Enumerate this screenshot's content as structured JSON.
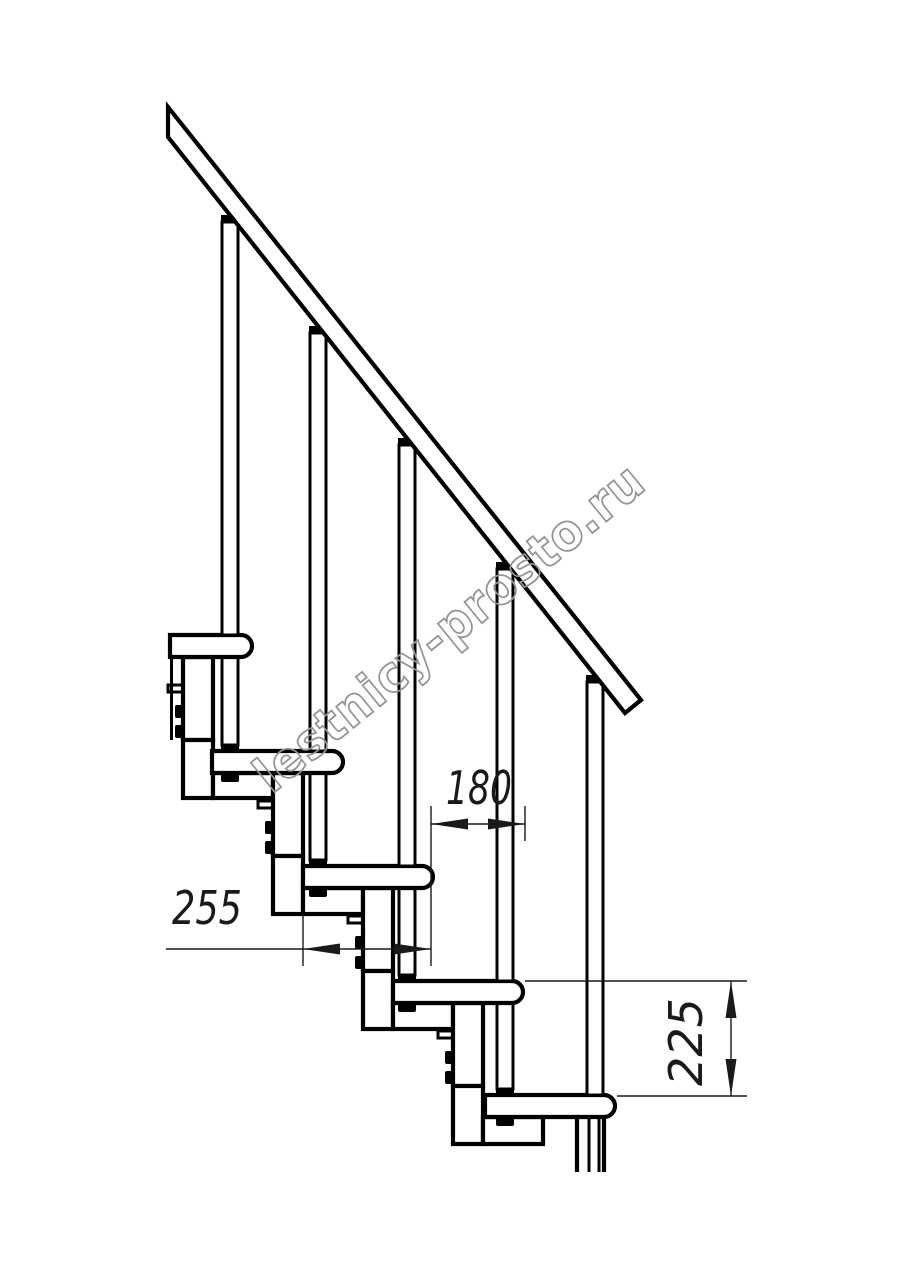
{
  "drawing": {
    "title": "modular staircase side elevation",
    "watermark": "lestnicy-prosto.ru",
    "dimensions": {
      "tread_depth": "255",
      "step_overlap": "180",
      "step_rise": "225"
    },
    "steps_visible": 5,
    "balusters_visible": 5
  },
  "colors": {
    "line": "#000000",
    "dim": "#1a1a1a",
    "wm": "#949494",
    "bg": "#ffffff"
  }
}
